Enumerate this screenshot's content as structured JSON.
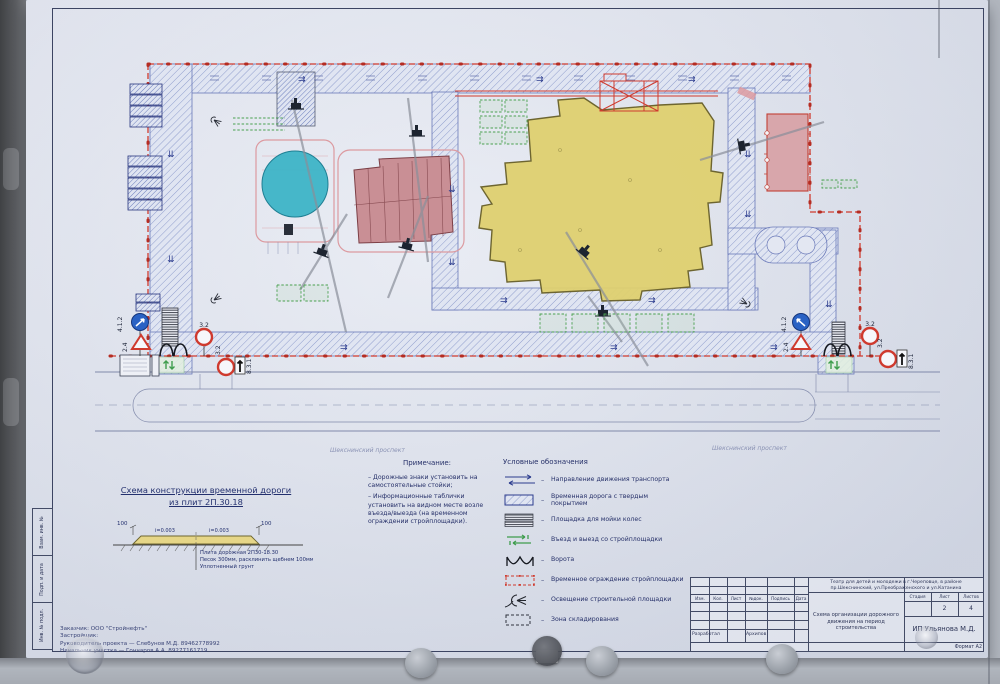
{
  "plan": {
    "street_left": "Шекснинский проспект",
    "street_right": "Шекснинский проспект",
    "sign_no_entry": "3.2",
    "sign_plate": "8.3.1",
    "sign_give_way": "2.4",
    "sign_route": "4.1.2"
  },
  "cross_section": {
    "title_line1": "Схема конструкции временной дороги",
    "title_line2": "из плит 2П.30.18",
    "dim_left": "100",
    "dim_right": "100",
    "slope_left": "i=0.003",
    "slope_right": "i=0.003",
    "callout_1": "Плита дорожная 2П30-18.30",
    "callout_2": "Песок 300мм, расклинить щебнем 100мм",
    "callout_3": "Уплотненный грунт"
  },
  "notes": {
    "title": "Примечание:",
    "items": [
      "– Дорожные знаки установить на самостоятельные стойки;",
      "– Информационные таблички установить на видном месте возле въезда/выезда (на временном ограждении стройплощадки)."
    ]
  },
  "legend": {
    "title": "Условные обозначения",
    "dash": "–",
    "items": [
      {
        "label": "Направление движения транспорта"
      },
      {
        "label": "Временная дорога с твердым покрытием"
      },
      {
        "label": "Площадка для мойки колес"
      },
      {
        "label": "Въезд и выезд со стройплощадки"
      },
      {
        "label": "Ворота"
      },
      {
        "label": "Временное ограждение стройплощадки"
      },
      {
        "label": "Освещение строительной площадки"
      },
      {
        "label": "Зона складирования"
      }
    ]
  },
  "contacts": {
    "line1": "Заказчик: ООО \"Стройнефть\"",
    "line2": "Застройщик:",
    "line3": "Руководитель проекта — Слебунов М.Д. 89462778992",
    "line4": "Начальник участка — Гончаров А.А. 89277161719"
  },
  "title_block": {
    "project": "Театр для детей и молодежи в г.Череповце, в районе пр.Шекснинский, ул.Преображенского и ул.Катанина",
    "rev_headers": [
      "Изм.",
      "Кол.",
      "Лист",
      "№док.",
      "Подпись",
      "Дата"
    ],
    "developer_role": "Разработал",
    "developer_name": "Архипов",
    "sheet_title": "Схема организации дорожного движения на период строительства",
    "stage_label": "Стадия",
    "sheet_label": "Лист",
    "sheets_label": "Листов",
    "sheet_no": "2",
    "sheets_total": "4",
    "company": "ИП Ульянова М.Д.",
    "format": "Формат А2"
  },
  "frame": {
    "side_top": "Взам. инв. №",
    "side_mid": "Подп. и дата",
    "side_bot": "Инв. № подл."
  }
}
